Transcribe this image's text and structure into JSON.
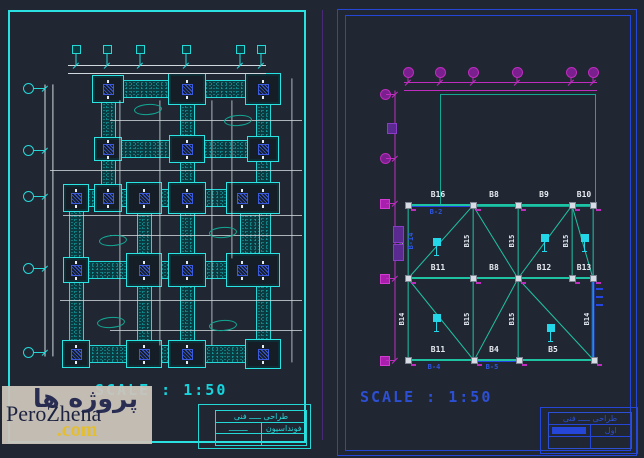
{
  "watermark": {
    "persian": "پروژه ها",
    "latin": "PeroZhena",
    "tld": ".com"
  },
  "colors": {
    "background": "#202733",
    "left_border": "#2ae0e0",
    "right_border": "#2546d6",
    "cyan": "#25d8d8",
    "teal_beam": "#1ec3a4",
    "blue_beam": "#2546e0",
    "magenta": "#bf2cbf",
    "white_dim": "#cfd8dc",
    "watermark_bg": "#cbc4bd",
    "watermark_text": "#2a2d52",
    "watermark_com": "#e5be2e"
  },
  "left": {
    "scale_label": "SCALE : 1:50",
    "title": {
      "row1": "طراحی ـــــ فنی",
      "row2_left": "ــــــــ",
      "row2_right": "فونداسیون"
    },
    "top_markers": [
      76,
      107,
      140,
      186,
      240,
      261
    ],
    "left_markers": [
      88,
      150,
      196,
      268,
      352
    ],
    "strips_h": [
      {
        "x": 92,
        "y": 88,
        "len": 186
      },
      {
        "x": 96,
        "y": 148,
        "len": 179
      },
      {
        "x": 63,
        "y": 197,
        "len": 215
      },
      {
        "x": 63,
        "y": 269,
        "len": 205
      },
      {
        "x": 63,
        "y": 353,
        "len": 213
      }
    ],
    "strips_v": [
      {
        "x": 107,
        "y": 88,
        "len": 109,
        "w": 13
      },
      {
        "x": 186,
        "y": 88,
        "len": 265,
        "w": 13
      },
      {
        "x": 262,
        "y": 88,
        "len": 265,
        "w": 13
      },
      {
        "x": 75,
        "y": 197,
        "len": 156,
        "w": 13
      },
      {
        "x": 143,
        "y": 197,
        "len": 156,
        "w": 13
      },
      {
        "x": 249,
        "y": 197,
        "len": 72,
        "w": 18
      }
    ],
    "pads": [
      {
        "x": 107,
        "y": 88,
        "w": 30,
        "h": 26,
        "a": 1
      },
      {
        "x": 186,
        "y": 88,
        "w": 36,
        "h": 30,
        "a": 1
      },
      {
        "x": 262,
        "y": 88,
        "w": 34,
        "h": 30,
        "a": 1
      },
      {
        "x": 107,
        "y": 148,
        "w": 26,
        "h": 22,
        "a": 1
      },
      {
        "x": 186,
        "y": 148,
        "w": 34,
        "h": 26,
        "a": 1
      },
      {
        "x": 262,
        "y": 148,
        "w": 30,
        "h": 24,
        "a": 1
      },
      {
        "x": 75,
        "y": 197,
        "w": 24,
        "h": 26,
        "a": 1
      },
      {
        "x": 107,
        "y": 197,
        "w": 26,
        "h": 26,
        "a": 1
      },
      {
        "x": 143,
        "y": 197,
        "w": 34,
        "h": 30,
        "a": 1
      },
      {
        "x": 186,
        "y": 197,
        "w": 36,
        "h": 30,
        "a": 1
      },
      {
        "x": 252,
        "y": 197,
        "w": 52,
        "h": 30,
        "a": 2
      },
      {
        "x": 75,
        "y": 269,
        "w": 24,
        "h": 24,
        "a": 1
      },
      {
        "x": 143,
        "y": 269,
        "w": 34,
        "h": 32,
        "a": 1
      },
      {
        "x": 186,
        "y": 269,
        "w": 36,
        "h": 32,
        "a": 1
      },
      {
        "x": 252,
        "y": 269,
        "w": 52,
        "h": 32,
        "a": 2
      },
      {
        "x": 75,
        "y": 353,
        "w": 26,
        "h": 26,
        "a": 1
      },
      {
        "x": 143,
        "y": 353,
        "w": 34,
        "h": 26,
        "a": 1
      },
      {
        "x": 186,
        "y": 353,
        "w": 36,
        "h": 26,
        "a": 1
      },
      {
        "x": 262,
        "y": 353,
        "w": 34,
        "h": 28,
        "a": 1
      }
    ],
    "dims": [
      [
        50,
        170,
        302,
        170
      ],
      [
        60,
        300,
        302,
        300
      ],
      [
        110,
        120,
        302,
        120
      ],
      [
        110,
        235,
        302,
        235
      ],
      [
        110,
        330,
        302,
        330
      ],
      [
        63,
        215,
        302,
        215
      ],
      [
        120,
        100,
        120,
        345
      ],
      [
        160,
        100,
        160,
        345
      ],
      [
        212,
        100,
        212,
        345
      ],
      [
        232,
        100,
        232,
        258
      ],
      [
        292,
        78,
        292,
        362
      ]
    ],
    "clouds": [
      {
        "x": 147,
        "y": 109
      },
      {
        "x": 237,
        "y": 120
      },
      {
        "x": 112,
        "y": 240
      },
      {
        "x": 222,
        "y": 232
      },
      {
        "x": 110,
        "y": 322
      },
      {
        "x": 222,
        "y": 325
      }
    ]
  },
  "right": {
    "scale_label": "SCALE : 1:50",
    "title": {
      "row1": "طراحی ـــــ فنی",
      "row2_right": "اول"
    },
    "top_markers": [
      408,
      440,
      473,
      517,
      571,
      593
    ],
    "left_markers": [
      {
        "y": 94,
        "s": "c"
      },
      {
        "y": 158,
        "s": "c"
      },
      {
        "y": 203,
        "s": "s"
      },
      {
        "y": 278,
        "s": "s"
      },
      {
        "y": 360,
        "s": "s"
      }
    ],
    "upper_outline": {
      "x": 440,
      "y": 94,
      "w": 154,
      "h": 111
    },
    "beams": [
      {
        "x1": 408,
        "y1": 205,
        "x2": 473,
        "y2": 205,
        "hl": true
      },
      {
        "x1": 473,
        "y1": 205,
        "x2": 518,
        "y2": 205
      },
      {
        "x1": 518,
        "y1": 205,
        "x2": 572,
        "y2": 205
      },
      {
        "x1": 572,
        "y1": 205,
        "x2": 593,
        "y2": 205
      },
      {
        "x1": 408,
        "y1": 278,
        "x2": 473,
        "y2": 278
      },
      {
        "x1": 473,
        "y1": 278,
        "x2": 518,
        "y2": 278
      },
      {
        "x1": 518,
        "y1": 278,
        "x2": 572,
        "y2": 278
      },
      {
        "x1": 572,
        "y1": 278,
        "x2": 593,
        "y2": 278
      },
      {
        "x1": 408,
        "y1": 360,
        "x2": 474,
        "y2": 360
      },
      {
        "x1": 474,
        "y1": 360,
        "x2": 519,
        "y2": 360,
        "hl": true
      },
      {
        "x1": 519,
        "y1": 360,
        "x2": 594,
        "y2": 360
      },
      {
        "x1": 408,
        "y1": 205,
        "x2": 408,
        "y2": 360
      },
      {
        "x1": 473,
        "y1": 205,
        "x2": 473,
        "y2": 360
      },
      {
        "x1": 518,
        "y1": 205,
        "x2": 518,
        "y2": 360
      },
      {
        "x1": 572,
        "y1": 205,
        "x2": 572,
        "y2": 278
      },
      {
        "x1": 593,
        "y1": 205,
        "x2": 593,
        "y2": 278
      },
      {
        "x1": 593,
        "y1": 278,
        "x2": 593,
        "y2": 360,
        "hl": true
      },
      {
        "x1": 408,
        "y1": 278,
        "x2": 473,
        "y2": 205,
        "d": true
      },
      {
        "x1": 473,
        "y1": 205,
        "x2": 518,
        "y2": 278,
        "d": true
      },
      {
        "x1": 518,
        "y1": 278,
        "x2": 572,
        "y2": 205,
        "d": true
      },
      {
        "x1": 572,
        "y1": 205,
        "x2": 593,
        "y2": 278,
        "d": true
      },
      {
        "x1": 408,
        "y1": 278,
        "x2": 474,
        "y2": 360,
        "d": true
      },
      {
        "x1": 518,
        "y1": 278,
        "x2": 474,
        "y2": 360,
        "d": true
      },
      {
        "x1": 518,
        "y1": 278,
        "x2": 594,
        "y2": 360,
        "d": true
      }
    ],
    "nodes": [
      [
        408,
        205
      ],
      [
        473,
        205
      ],
      [
        518,
        205
      ],
      [
        572,
        205
      ],
      [
        593,
        205
      ],
      [
        408,
        278
      ],
      [
        473,
        278
      ],
      [
        518,
        278
      ],
      [
        572,
        278
      ],
      [
        593,
        278
      ],
      [
        408,
        360
      ],
      [
        474,
        360
      ],
      [
        519,
        360
      ],
      [
        594,
        360
      ]
    ],
    "symbols": [
      [
        437,
        242
      ],
      [
        545,
        238
      ],
      [
        585,
        238
      ],
      [
        437,
        318
      ],
      [
        551,
        328
      ]
    ],
    "h_labels": [
      {
        "x": 438,
        "y": 194,
        "t": "B16"
      },
      {
        "x": 494,
        "y": 194,
        "t": "B8"
      },
      {
        "x": 544,
        "y": 194,
        "t": "B9"
      },
      {
        "x": 584,
        "y": 194,
        "t": "B10"
      },
      {
        "x": 438,
        "y": 267,
        "t": "B11"
      },
      {
        "x": 494,
        "y": 267,
        "t": "B8"
      },
      {
        "x": 544,
        "y": 267,
        "t": "B12"
      },
      {
        "x": 584,
        "y": 267,
        "t": "B13"
      },
      {
        "x": 438,
        "y": 349,
        "t": "B11"
      },
      {
        "x": 494,
        "y": 349,
        "t": "B4"
      },
      {
        "x": 553,
        "y": 349,
        "t": "B5"
      }
    ],
    "v_labels": [
      {
        "x": 402,
        "y": 241,
        "t": "B15"
      },
      {
        "x": 402,
        "y": 319,
        "t": "B14"
      },
      {
        "x": 467,
        "y": 241,
        "t": "B15"
      },
      {
        "x": 467,
        "y": 319,
        "t": "B15"
      },
      {
        "x": 512,
        "y": 241,
        "t": "B15"
      },
      {
        "x": 512,
        "y": 319,
        "t": "B15"
      },
      {
        "x": 566,
        "y": 241,
        "t": "B15"
      },
      {
        "x": 587,
        "y": 319,
        "t": "B14"
      }
    ],
    "sub_labels": [
      {
        "x": 436,
        "y": 208,
        "t": "B-2",
        "rot": false
      },
      {
        "x": 434,
        "y": 363,
        "t": "B-4",
        "rot": false
      },
      {
        "x": 492,
        "y": 363,
        "t": "B-5",
        "rot": false
      },
      {
        "x": 411,
        "y": 241,
        "t": "B-14",
        "rot": true
      }
    ],
    "purple_blocks": [
      {
        "x": 393,
        "y": 226,
        "w": 9,
        "h": 15
      },
      {
        "x": 393,
        "y": 244,
        "w": 9,
        "h": 15
      },
      {
        "x": 387,
        "y": 123,
        "w": 8,
        "h": 9
      }
    ]
  }
}
